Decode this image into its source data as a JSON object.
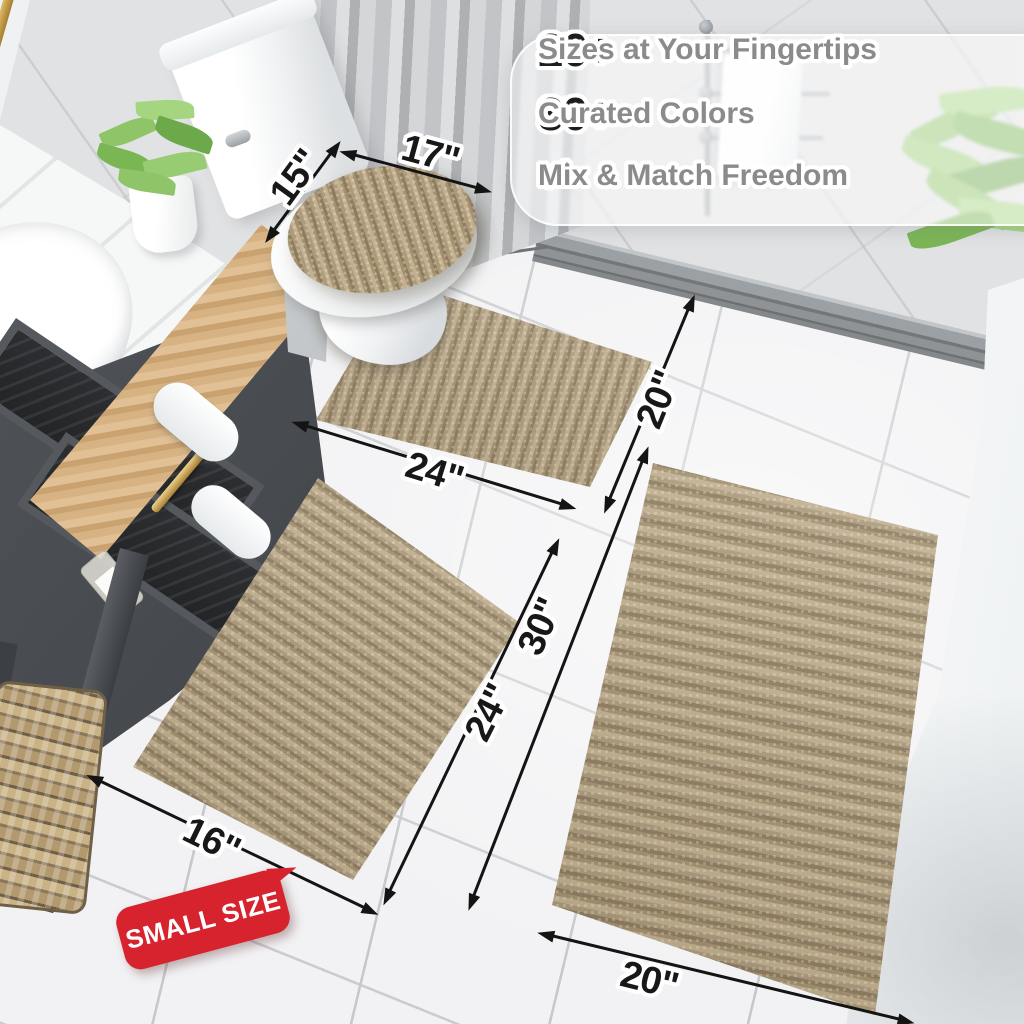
{
  "features": {
    "items": [
      {
        "count": "20+",
        "label": "Sizes at Your Fingertips"
      },
      {
        "count": "30+",
        "label": "Curated Colors"
      },
      {
        "count": "",
        "label": "Mix & Match Freedom"
      }
    ]
  },
  "icons": {
    "check": "✓"
  },
  "badge": {
    "label": "SMALL SIZE"
  },
  "dims": {
    "lid_depth": "15\"",
    "lid_width": "17\"",
    "contour_width": "24\"",
    "contour_depth": "20\"",
    "small_length": "24\"",
    "small_width": "16\"",
    "large_length": "30\"",
    "large_width": "20\""
  },
  "colors": {
    "rug_base": "#b2a081",
    "rug_dark": "#8d7b5e",
    "rug_light": "#c2b090",
    "badge_red": "#d6232e",
    "check_gray": "#8f8f8f",
    "number_black": "#1d1d1d",
    "feature_gray": "#8b8b8b",
    "dimension_black": "#181818",
    "brass": "#c9a050",
    "wood": "#d0ab79",
    "vanity_dark": "#2c2e31"
  }
}
